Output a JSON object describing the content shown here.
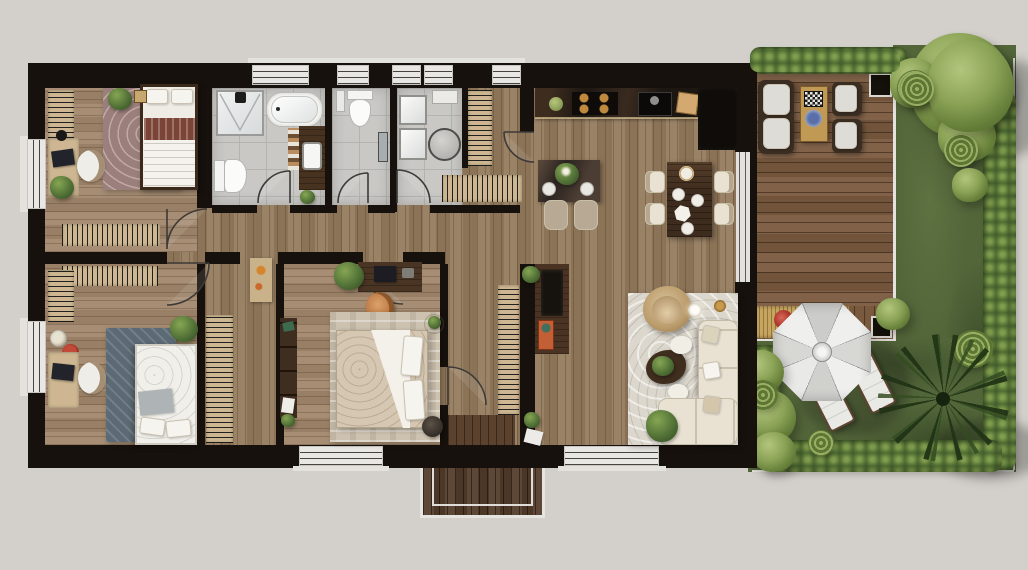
{
  "scene": {
    "kind": "architectural-floor-plan-render",
    "view": "top-down",
    "areas": [
      "bedroom-1",
      "bathroom",
      "wc",
      "utility-room",
      "entry-hall",
      "kitchen",
      "dining-area",
      "living-room",
      "bedroom-2",
      "wardrobe-corridor",
      "bedroom-3",
      "rear-hall",
      "wood-deck",
      "garden-lawn",
      "entry-porch"
    ],
    "furniture": [
      "double-bed",
      "single-bed",
      "bathtub",
      "shower",
      "toilet",
      "vanity-sink",
      "washer",
      "dryer",
      "dining-table",
      "breakfast-table",
      "kitchen-counter",
      "hob",
      "kitchen-sink",
      "sofa",
      "armchair",
      "coffee-table",
      "tv-console",
      "desk",
      "desk-chair",
      "wardrobe",
      "radiator",
      "outdoor-sofa",
      "outdoor-armchair",
      "outdoor-coffee-table",
      "parasol-umbrella",
      "sun-lounger",
      "planter",
      "hedge",
      "tree",
      "palm-tree",
      "house-plant"
    ]
  },
  "palette": {
    "bg": "#d3d0cb",
    "wall": "#17110d",
    "woodFloor": "#947a5c",
    "woodBedroom": "#a0866a",
    "tileBath": "#c9c8c5",
    "deckWood": "#7a5a3f",
    "porchWood": "#543d2b",
    "grassGreen": "#53663a",
    "hedgeGreen": "#47602e",
    "treeGreen": "#8ba356",
    "palmGreen": "#213416",
    "rugMauve": "#9b7f7c",
    "rugBlue": "#5c6a75",
    "rugBeige": "#cdc2b0",
    "rugLiving": "#dcd7cc",
    "tanOak": "#cdb691",
    "darkWalnut": "#46321f",
    "creamSofa": "#e9e2d2",
    "counterBlack": "#1b1511",
    "burnerGold": "#c08a3e",
    "accentOrange": "#c25f35",
    "flowerRed": "#b23b2e",
    "umbrellaWhite": "#ececea",
    "glassGray": "#e9e7e3"
  }
}
